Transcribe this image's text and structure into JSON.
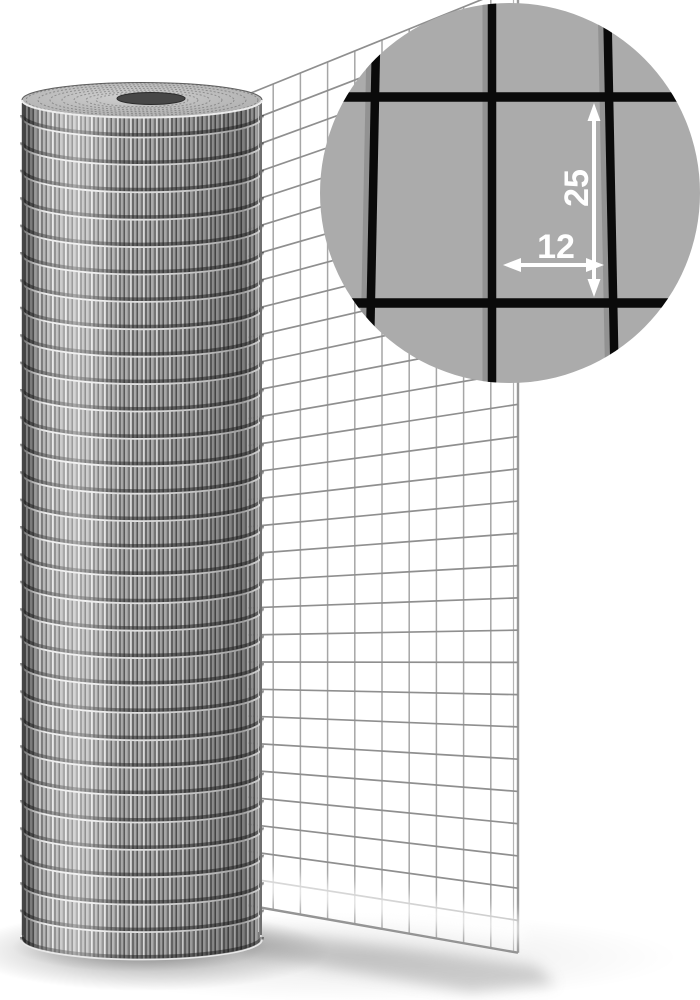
{
  "image": {
    "subject": "galvanized welded wire mesh roll with partially unrolled sheet and magnified detail inset"
  },
  "inset": {
    "label_height": "25",
    "label_width": "12",
    "bg_color": "#ababab",
    "wire_color": "#0a0a0a",
    "wire_shadow_color": "#8f8f8f",
    "annotation_color": "#ffffff",
    "cx": 510,
    "cy": 193,
    "r": 190,
    "v_wires": [
      {
        "x1": 377,
        "x2": 369
      },
      {
        "x1": 492,
        "x2": 492
      },
      {
        "x1": 607,
        "x2": 615
      }
    ],
    "h_wires": [
      97,
      303
    ],
    "v_wire_w": 8.5,
    "h_wire_w": 9.5
  },
  "sheet": {
    "left": 246,
    "right": 518,
    "top_y": 95,
    "row_spacing": 27,
    "rows": 31,
    "cols": 11,
    "vp_x": -1150,
    "vp_y": 660,
    "h_color": "#8f8f8f",
    "v_color": "#a6a6a6",
    "edge_color": "#9a9a9a"
  },
  "roll": {
    "left": 22,
    "right": 262,
    "top_cy": 100,
    "rx": 120,
    "top_ry": 17.5,
    "body_bottom": 939,
    "ring_start": 117,
    "ring_spacing": 27.4,
    "rings": 31,
    "ring_light": "#e8e8e8",
    "ring_dark": "#1e1e1e",
    "top_ring_radii": [
      116,
      104,
      92,
      80,
      68,
      56,
      46
    ],
    "hole": {
      "cx": 151,
      "cy": 98.5,
      "rx": 34,
      "ry": 6,
      "fill": "#474747",
      "stroke": "#2b2b2b"
    }
  },
  "palette": {
    "background": "#ffffff",
    "shadow": "#8a8a8a",
    "roll_stripe_light": "#e3e3e3",
    "roll_stripe_dark": "#585858"
  }
}
